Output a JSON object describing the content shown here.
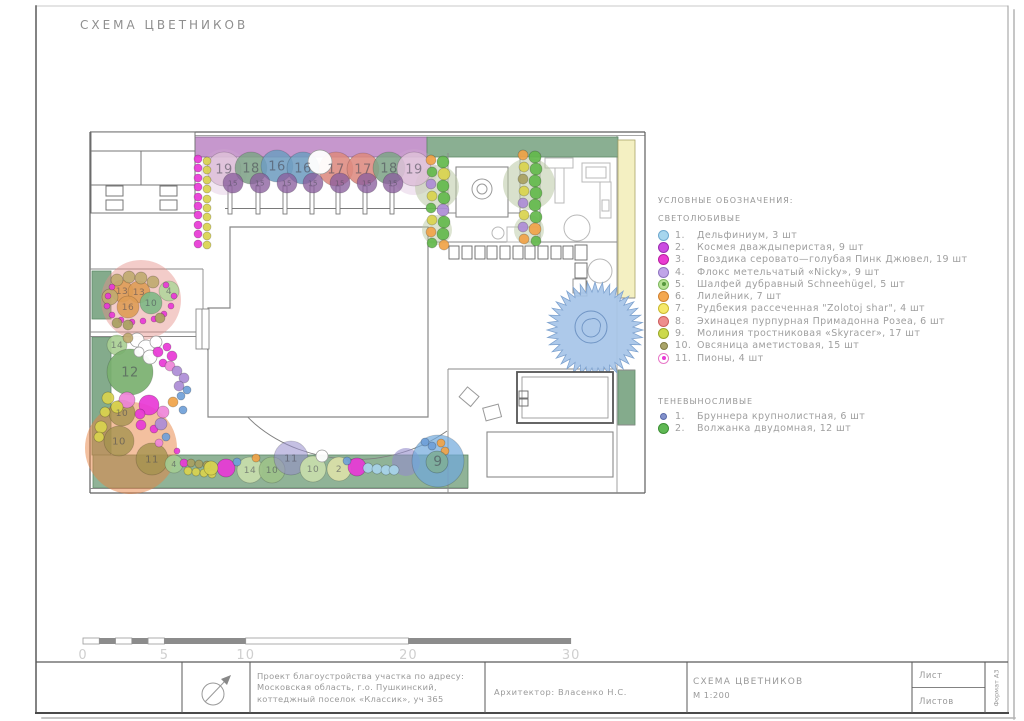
{
  "title": "СХЕМА ЦВЕТНИКОВ",
  "legend": {
    "heading": "УСЛОВНЫЕ ОБОЗНАЧЕНИЯ:",
    "sun": {
      "heading": "СВЕТОЛЮБИВЫЕ",
      "items": [
        {
          "num": "1.",
          "label": "Дельфиниум, 3 шт",
          "color": "#a7d6ee",
          "border": "#6fa9cf"
        },
        {
          "num": "2.",
          "label": "Космея дваждыперистая, 9 шт",
          "color": "#cb4ce2",
          "border": "#9a2fb0"
        },
        {
          "num": "3.",
          "label": "Гвоздика серовато—голубая Пинк Джювел, 19 шт",
          "color": "#ea3bd2",
          "border": "#b81fa0"
        },
        {
          "num": "4.",
          "label": "Флокс метельчатый «Nicky», 9 шт",
          "color": "#c0a5e8",
          "border": "#8f75c0"
        },
        {
          "num": "5.",
          "label": "Шалфей дубравный Schneehügel, 5 шт",
          "color": "#b7e195",
          "border": "#7fb85f",
          "center_color": "#55973d"
        },
        {
          "num": "6.",
          "label": "Лилейник, 7 шт",
          "color": "#f4a851",
          "border": "#cf8030"
        },
        {
          "num": "7.",
          "label": "Рудбекия рассеченная \"Zolotoj shar\", 4 шт",
          "color": "#f6e869",
          "border": "#c9b92f"
        },
        {
          "num": "8.",
          "label": "Эхинацея пурпурная Примадонна Розеа, 6 шт",
          "color": "#ee8d8d",
          "border": "#cc5f5f"
        },
        {
          "num": "9.",
          "label": "Молиния тростниковая «Skyracer», 17 шт",
          "color": "#ccd94b",
          "border": "#9aa82a"
        },
        {
          "num": "10.",
          "label": "Овсяница аметистовая, 15 шт",
          "color": "#a9a468",
          "border": "#817c45"
        },
        {
          "num": "11.",
          "label": "Пионы, 4 шт",
          "color": "#ffffff",
          "border": "#e878c8",
          "center_color": "#e83ad6"
        }
      ]
    },
    "shade": {
      "heading": "ТЕНЕВЫНОСЛИВЫЕ",
      "items": [
        {
          "num": "1.",
          "label": "Бруннера крупнолистная,  6 шт",
          "color": "#8291cc",
          "border": "#5a6aa8"
        },
        {
          "num": "2.",
          "label": "Волжанка двудомная, 12 шт",
          "color": "#5fb854",
          "border": "#3d8f35"
        }
      ]
    }
  },
  "scale_bar": {
    "labels": [
      "0",
      "5",
      "10",
      "20",
      "30"
    ],
    "x0": 83,
    "y": 638,
    "px_per_m": 16.27,
    "pattern": [
      [
        0,
        1,
        0
      ],
      [
        1,
        2,
        1
      ],
      [
        2,
        3,
        0
      ],
      [
        3,
        4,
        1
      ],
      [
        4,
        5,
        0
      ],
      [
        5,
        10,
        1
      ],
      [
        10,
        20,
        0
      ],
      [
        20,
        30,
        1
      ]
    ]
  },
  "title_block": {
    "project_lines": [
      "Проект благоустройства участка по адресу:",
      "Московская область, г.о. Пушкинский,",
      "коттеджный поселок «Классик», уч 365"
    ],
    "architect": "Архитектор:  Власенко  Н.С.",
    "sheet_title": "СХЕМА ЦВЕТНИКОВ",
    "sheet_scale": "М 1:200",
    "sheet_label": "Лист",
    "sheets_label": "Листов",
    "format_label": "Формат А3"
  },
  "plan": {
    "palette": {
      "mg": "#e838d6",
      "yl": "#d9d24e",
      "og": "#f0a348",
      "gn": "#63b84c",
      "pu": "#ad8cd6",
      "bl": "#6f9fd8",
      "lb": "#a8d4ea",
      "ol": "#a8a060",
      "tn": "#c0aa70",
      "pk": "#ef86d8",
      "wh": "#ffffff",
      "tl": "#7fae9a"
    },
    "hedge_purple": "#c08cc8",
    "hedge_green": "#84ab8c",
    "strip_yellow": "#f4f0c2",
    "spruce_blue": "#a6c4e8",
    "overlays": [
      [
        224,
        172,
        23,
        "#d0a8d0",
        0.3
      ],
      [
        414,
        172,
        23,
        "#d0a8d0",
        0.3
      ],
      [
        437,
        187,
        22,
        "#b9c9a4",
        0.55
      ],
      [
        437,
        230,
        15,
        "#b9c9a4",
        0.5
      ],
      [
        529,
        184,
        26,
        "#b9c9a4",
        0.55
      ],
      [
        529,
        230,
        15,
        "#b9c9a4",
        0.5
      ],
      [
        141,
        300,
        40,
        "#e58f88",
        0.45
      ],
      [
        131,
        448,
        46,
        "#e8813f",
        0.5
      ],
      [
        406,
        462,
        14,
        "#958ccc",
        0.6
      ]
    ],
    "markers": [
      [
        224,
        169,
        17,
        "#ddbfd8",
        "19",
        13,
        0.88
      ],
      [
        251,
        168,
        16,
        "#7fa489",
        "18",
        13,
        0.88
      ],
      [
        277,
        166,
        16,
        "#6f9dc0",
        "16",
        13,
        0.88
      ],
      [
        303,
        168,
        16,
        "#6f9dc0",
        "16",
        13,
        0.88
      ],
      [
        336,
        169,
        17,
        "#dd8a80",
        "17",
        13,
        0.88
      ],
      [
        363,
        169,
        16,
        "#dd8a80",
        "17",
        13,
        0.88
      ],
      [
        389,
        168,
        16,
        "#7fa489",
        "18",
        13,
        0.88
      ],
      [
        414,
        169,
        17,
        "#ddbfd8",
        "19",
        13,
        0.88
      ],
      [
        233,
        183,
        10,
        "#8a5f9e",
        "15",
        7,
        0.78
      ],
      [
        260,
        183,
        10,
        "#8a5f9e",
        "15",
        7,
        0.78
      ],
      [
        287,
        183,
        10,
        "#8a5f9e",
        "15",
        7,
        0.78
      ],
      [
        313,
        183,
        10,
        "#8a5f9e",
        "15",
        7,
        0.78
      ],
      [
        340,
        183,
        10,
        "#8a5f9e",
        "15",
        7,
        0.78
      ],
      [
        367,
        183,
        10,
        "#8a5f9e",
        "15",
        7,
        0.78
      ],
      [
        393,
        183,
        10,
        "#8a5f9e",
        "15",
        7,
        0.78
      ],
      [
        122,
        291,
        11,
        "#de9c55",
        "13",
        9,
        0.9
      ],
      [
        139,
        292,
        11,
        "#de9c55",
        "13",
        9,
        0.9
      ],
      [
        128,
        307,
        11,
        "#de9c55",
        "16",
        9,
        0.9
      ],
      [
        151,
        303,
        11,
        "#7db885",
        "10",
        9,
        0.9
      ],
      [
        169,
        291,
        10,
        "#b2d59c",
        "4",
        9,
        0.9
      ],
      [
        117,
        345,
        10,
        "#a8cf92",
        "14",
        9,
        0.9
      ],
      [
        130,
        372,
        23,
        "#79b06f",
        "12",
        13,
        0.92
      ],
      [
        122,
        413,
        13,
        "#a5924f",
        "10",
        9,
        0.8
      ],
      [
        119,
        441,
        15,
        "#a5924f",
        "10",
        10,
        0.8
      ],
      [
        152,
        459,
        16,
        "#a5924f",
        "11",
        10,
        0.8
      ],
      [
        174,
        464,
        9,
        "#a3cc92",
        "4",
        8,
        0.9
      ],
      [
        250,
        470,
        13,
        "#c6dcab",
        "14",
        9,
        0.95
      ],
      [
        272,
        470,
        13,
        "#9dc289",
        "10",
        9,
        0.95
      ],
      [
        291,
        458,
        17,
        "#958ccc",
        "11",
        10,
        0.55
      ],
      [
        313,
        469,
        13,
        "#c6dcab",
        "10",
        9,
        0.95
      ],
      [
        339,
        469,
        12,
        "#d9dfa8",
        "2",
        9,
        0.95
      ],
      [
        438,
        461,
        26,
        "#6fa8dc",
        "9",
        14,
        0.7
      ]
    ],
    "dots": [
      [
        198,
        159,
        4,
        "mg"
      ],
      [
        198,
        168,
        4,
        "mg"
      ],
      [
        198,
        178,
        4,
        "mg"
      ],
      [
        198,
        187,
        4,
        "mg"
      ],
      [
        198,
        197,
        4,
        "mg"
      ],
      [
        198,
        206,
        4,
        "mg"
      ],
      [
        198,
        215,
        4,
        "mg"
      ],
      [
        198,
        225,
        4,
        "mg"
      ],
      [
        198,
        234,
        4,
        "mg"
      ],
      [
        198,
        244,
        4,
        "mg"
      ],
      [
        207,
        161,
        4,
        "yl"
      ],
      [
        207,
        170,
        4,
        "yl"
      ],
      [
        207,
        180,
        4,
        "yl"
      ],
      [
        207,
        189,
        4,
        "yl"
      ],
      [
        207,
        199,
        4,
        "yl"
      ],
      [
        207,
        208,
        4,
        "yl"
      ],
      [
        207,
        217,
        4,
        "yl"
      ],
      [
        207,
        227,
        4,
        "yl"
      ],
      [
        207,
        236,
        4,
        "yl"
      ],
      [
        207,
        245,
        4,
        "yl"
      ],
      [
        431,
        160,
        5,
        "og"
      ],
      [
        443,
        162,
        6,
        "gn"
      ],
      [
        432,
        172,
        5,
        "gn"
      ],
      [
        444,
        174,
        6,
        "yl"
      ],
      [
        431,
        184,
        5,
        "pu"
      ],
      [
        443,
        186,
        6,
        "gn"
      ],
      [
        432,
        196,
        5,
        "yl"
      ],
      [
        444,
        198,
        6,
        "gn"
      ],
      [
        431,
        208,
        5,
        "gn"
      ],
      [
        443,
        210,
        6,
        "pu"
      ],
      [
        432,
        220,
        5,
        "yl"
      ],
      [
        444,
        222,
        6,
        "gn"
      ],
      [
        431,
        232,
        5,
        "og"
      ],
      [
        443,
        234,
        6,
        "gn"
      ],
      [
        432,
        243,
        5,
        "gn"
      ],
      [
        444,
        245,
        5,
        "og"
      ],
      [
        523,
        155,
        5,
        "og"
      ],
      [
        535,
        157,
        6,
        "gn"
      ],
      [
        524,
        167,
        5,
        "yl"
      ],
      [
        536,
        169,
        6,
        "gn"
      ],
      [
        523,
        179,
        5,
        "ol"
      ],
      [
        535,
        181,
        6,
        "gn"
      ],
      [
        524,
        191,
        5,
        "yl"
      ],
      [
        536,
        193,
        6,
        "gn"
      ],
      [
        523,
        203,
        5,
        "pu"
      ],
      [
        535,
        205,
        6,
        "gn"
      ],
      [
        524,
        215,
        5,
        "yl"
      ],
      [
        536,
        217,
        6,
        "gn"
      ],
      [
        523,
        227,
        5,
        "pu"
      ],
      [
        535,
        229,
        6,
        "og"
      ],
      [
        524,
        239,
        5,
        "og"
      ],
      [
        536,
        241,
        5,
        "gn"
      ],
      [
        117,
        280,
        6,
        "tn"
      ],
      [
        129,
        277,
        6,
        "tn"
      ],
      [
        141,
        278,
        6,
        "tn"
      ],
      [
        153,
        282,
        6,
        "tn"
      ],
      [
        110,
        297,
        8,
        "tn"
      ],
      [
        112,
        287,
        3,
        "mg"
      ],
      [
        108,
        296,
        3,
        "mg"
      ],
      [
        107,
        306,
        3,
        "mg"
      ],
      [
        112,
        315,
        3,
        "mg"
      ],
      [
        121,
        320,
        3,
        "mg"
      ],
      [
        132,
        322,
        3,
        "mg"
      ],
      [
        143,
        321,
        3,
        "mg"
      ],
      [
        154,
        319,
        3,
        "mg"
      ],
      [
        164,
        314,
        3,
        "mg"
      ],
      [
        171,
        306,
        3,
        "mg"
      ],
      [
        174,
        296,
        3,
        "mg"
      ],
      [
        166,
        285,
        3,
        "mg"
      ],
      [
        117,
        323,
        5,
        "ol"
      ],
      [
        128,
        325,
        5,
        "ol"
      ],
      [
        160,
        318,
        5,
        "ol"
      ],
      [
        137,
        340,
        7,
        "wh"
      ],
      [
        146,
        348,
        8,
        "wh"
      ],
      [
        156,
        342,
        6,
        "wh"
      ],
      [
        150,
        357,
        7,
        "wh"
      ],
      [
        139,
        352,
        5,
        "wh"
      ],
      [
        128,
        338,
        5,
        "tn"
      ],
      [
        158,
        352,
        5,
        "mg"
      ],
      [
        167,
        347,
        4,
        "mg"
      ],
      [
        172,
        356,
        5,
        "mg"
      ],
      [
        163,
        363,
        4,
        "mg"
      ],
      [
        170,
        366,
        5,
        "pk"
      ],
      [
        127,
        400,
        8,
        "pk"
      ],
      [
        163,
        412,
        6,
        "pk"
      ],
      [
        159,
        443,
        4,
        "pk"
      ],
      [
        149,
        405,
        10,
        "mg"
      ],
      [
        226,
        468,
        9,
        "mg"
      ],
      [
        357,
        467,
        9,
        "mg"
      ],
      [
        140,
        414,
        5,
        "mg"
      ],
      [
        141,
        425,
        5,
        "mg"
      ],
      [
        154,
        429,
        4,
        "mg"
      ],
      [
        177,
        451,
        3,
        "mg"
      ],
      [
        184,
        463,
        4,
        "mg"
      ],
      [
        177,
        371,
        5,
        "pu"
      ],
      [
        184,
        378,
        5,
        "pu"
      ],
      [
        179,
        386,
        5,
        "pu"
      ],
      [
        161,
        424,
        6,
        "pu"
      ],
      [
        187,
        390,
        4,
        "bl"
      ],
      [
        181,
        396,
        4,
        "bl"
      ],
      [
        183,
        410,
        4,
        "bl"
      ],
      [
        166,
        437,
        4,
        "bl"
      ],
      [
        237,
        462,
        4,
        "bl"
      ],
      [
        347,
        461,
        4,
        "bl"
      ],
      [
        432,
        446,
        4,
        "bl"
      ],
      [
        425,
        442,
        4,
        "bl"
      ],
      [
        173,
        402,
        5,
        "og"
      ],
      [
        256,
        458,
        4,
        "og"
      ],
      [
        441,
        443,
        4,
        "og"
      ],
      [
        445,
        451,
        4,
        "og"
      ],
      [
        108,
        398,
        6,
        "yl"
      ],
      [
        117,
        407,
        6,
        "yl"
      ],
      [
        105,
        412,
        5,
        "yl"
      ],
      [
        101,
        427,
        6,
        "yl"
      ],
      [
        99,
        437,
        5,
        "yl"
      ],
      [
        191,
        463,
        4,
        "ol"
      ],
      [
        199,
        464,
        4,
        "ol"
      ],
      [
        207,
        465,
        4,
        "ol"
      ],
      [
        188,
        471,
        4,
        "yl"
      ],
      [
        196,
        472,
        4,
        "yl"
      ],
      [
        204,
        473,
        4,
        "yl"
      ],
      [
        212,
        474,
        4,
        "yl"
      ],
      [
        211,
        468,
        7,
        "yl"
      ],
      [
        368,
        468,
        5,
        "lb"
      ],
      [
        377,
        469,
        5,
        "lb"
      ],
      [
        386,
        470,
        5,
        "lb"
      ],
      [
        394,
        470,
        5,
        "lb"
      ],
      [
        322,
        456,
        6,
        "wh"
      ],
      [
        320,
        162,
        12,
        "wh"
      ],
      [
        437,
        462,
        11,
        "tl"
      ]
    ]
  }
}
